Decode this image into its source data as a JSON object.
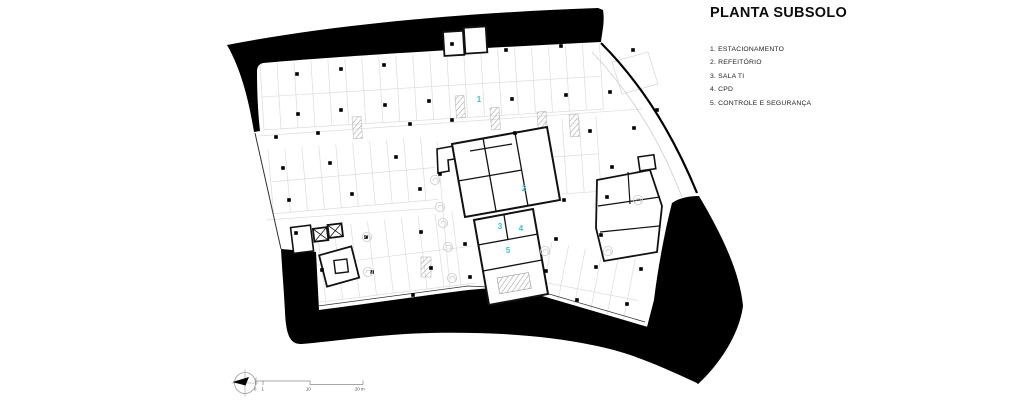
{
  "header": {
    "title": "PLANTA SUBSOLO"
  },
  "legend": {
    "items": [
      "1. ESTACIONAMENTO",
      "2. REFEITÓRIO",
      "3. SALA TI",
      "4. CPD",
      "5. CONTROLE E SEGURANÇA"
    ]
  },
  "plan": {
    "area_labels": [
      {
        "text": "1"
      },
      {
        "text": "2"
      },
      {
        "text": "3"
      },
      {
        "text": "4"
      },
      {
        "text": "5"
      }
    ],
    "label_color": "#3fbfc1"
  },
  "scalebar": {
    "labels": [
      "0",
      "1",
      "10",
      "20 m"
    ]
  },
  "colors": {
    "poche": "#000000",
    "wall": "#111111",
    "parking_line": "#dcdcdc",
    "accent": "#3fbfc1"
  }
}
